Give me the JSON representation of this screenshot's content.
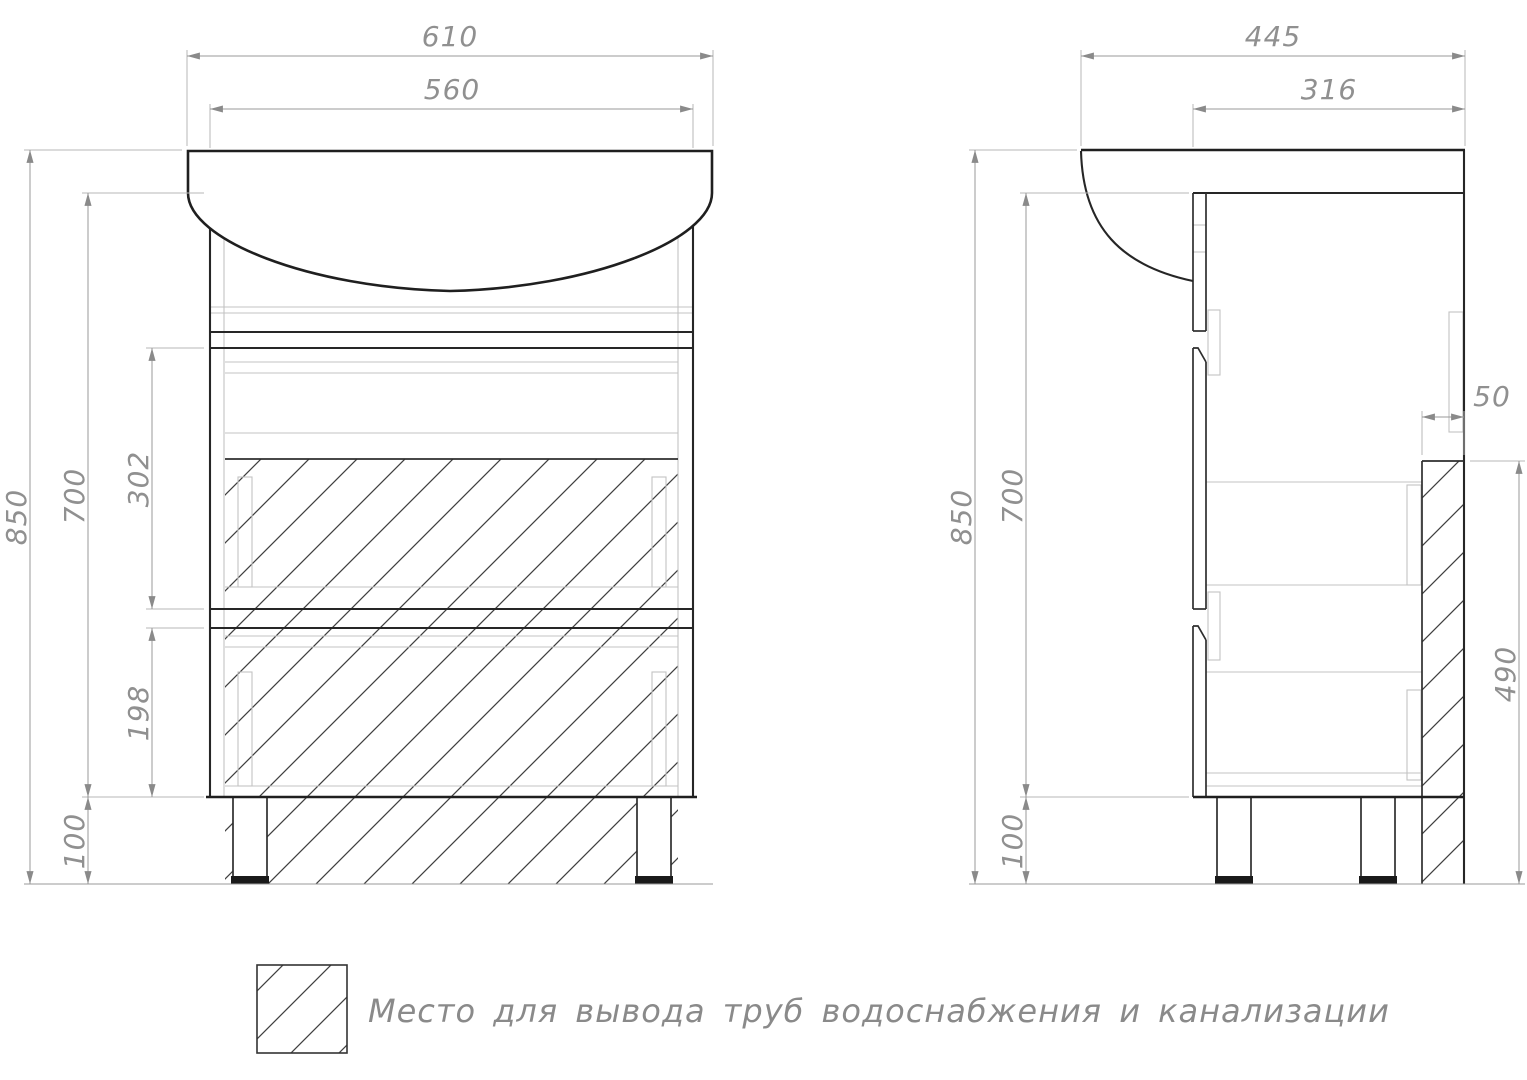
{
  "drawing": {
    "background": "#ffffff",
    "outline_color": "#1f1f1f",
    "dim_color": "#909090",
    "hatch_color": "#3f3f3f",
    "front_view": {
      "dims": {
        "total_width": "610",
        "cabinet_width": "560",
        "total_height": "850",
        "cabinet_height": "700",
        "upper_drawer_height": "302",
        "lower_drawer_height": "198",
        "legs_height": "100"
      }
    },
    "side_view": {
      "dims": {
        "total_depth": "445",
        "cabinet_depth": "316",
        "pipe_zone_depth": "50",
        "total_height": "850",
        "cabinet_height": "700",
        "pipe_zone_height": "490",
        "legs_height": "100"
      }
    },
    "legend": {
      "symbol": "hatch-square",
      "text": "Место для вывода труб водоснабжения и канализации"
    }
  }
}
